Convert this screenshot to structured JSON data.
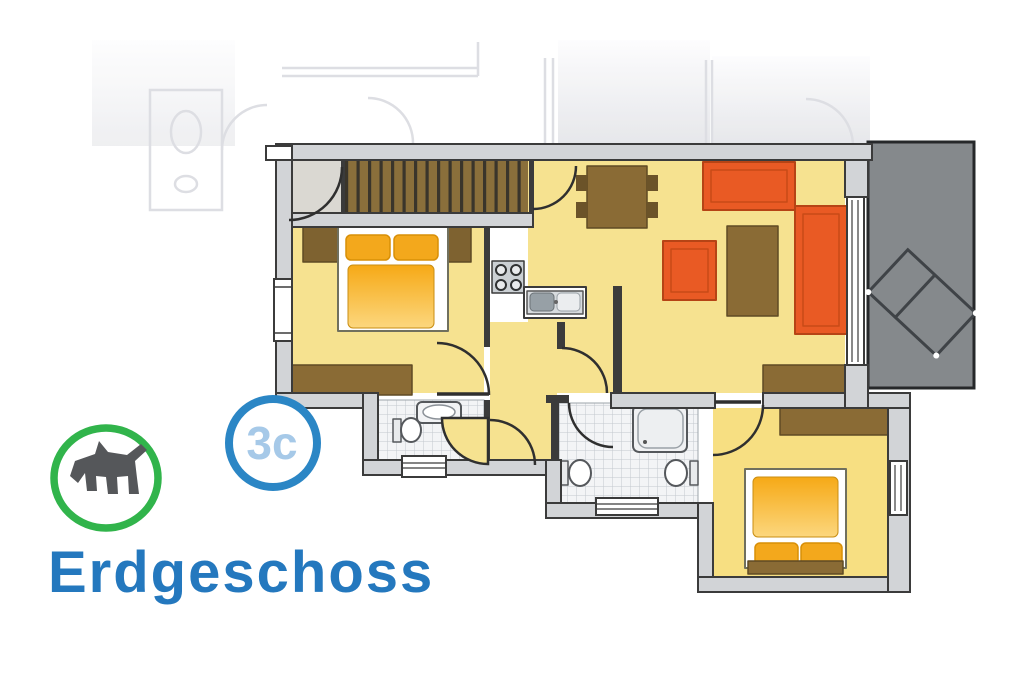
{
  "floor_plan": {
    "title": "Erdgeschoss",
    "title_color": "#2478BE",
    "apartment_badge": {
      "label": "3c",
      "ring_color": "#2B86C5",
      "text_color": "#A6C9E8"
    },
    "pet_badge": {
      "icon": "dog-icon",
      "ring_color": "#31B44B",
      "icon_color": "#55575A"
    },
    "colors": {
      "room_yellow": "#F6E290",
      "bedroom2_yellow": "#F7DF82",
      "furniture_orange": "#E95A24",
      "bed_orange": "#F3A81C",
      "furniture_brown": "#8A6B35",
      "wall_gray": "#D2D4D7",
      "wall_outline": "#3B3B3B",
      "terrace_gray": "#85898C",
      "entrance_gray": "#DAD8D2"
    },
    "rooms": [
      {
        "name": "entrance"
      },
      {
        "name": "staircase"
      },
      {
        "name": "bedroom-1"
      },
      {
        "name": "kitchen"
      },
      {
        "name": "living-room"
      },
      {
        "name": "hallway"
      },
      {
        "name": "bathroom-1"
      },
      {
        "name": "bathroom-2"
      },
      {
        "name": "bedroom-2"
      },
      {
        "name": "terrace"
      }
    ]
  }
}
